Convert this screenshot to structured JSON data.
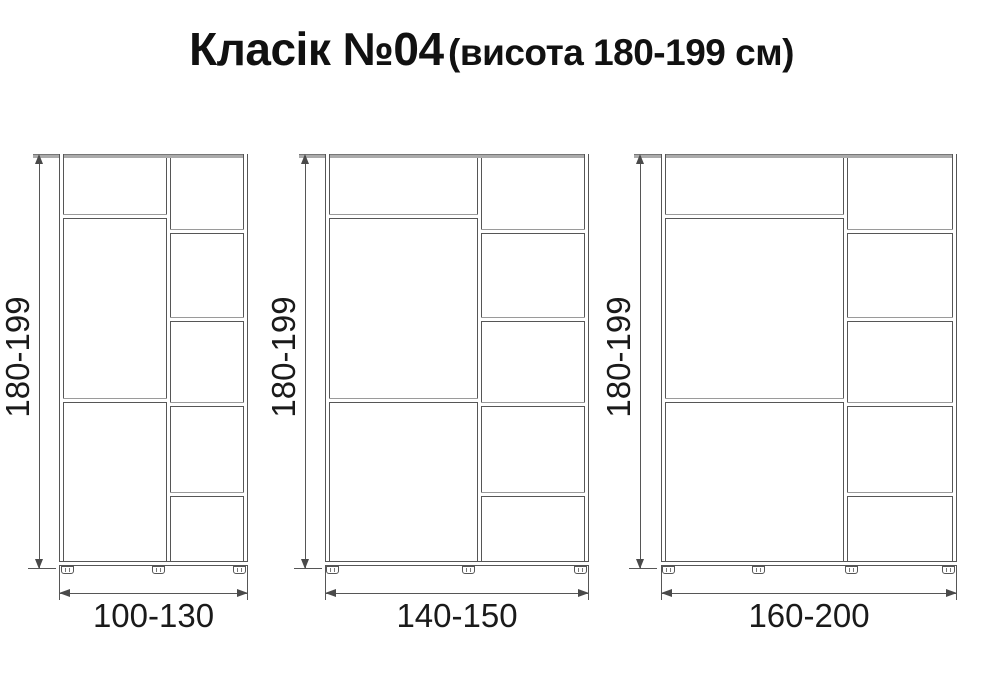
{
  "title": {
    "main": "Класік №04",
    "subtitle": "(висота 180-199 см)"
  },
  "wardrobes": [
    {
      "name": "wardrobe-small",
      "height_label": "180-199",
      "width_label": "100-130"
    },
    {
      "name": "wardrobe-medium",
      "height_label": "180-199",
      "width_label": "140-150"
    },
    {
      "name": "wardrobe-large",
      "height_label": "180-199",
      "width_label": "160-200"
    }
  ],
  "colors": {
    "line": "#565656",
    "shelf_highlight": "#9a9a9a",
    "top_panel": "#ababab",
    "text": "#111111",
    "background": "#ffffff"
  }
}
